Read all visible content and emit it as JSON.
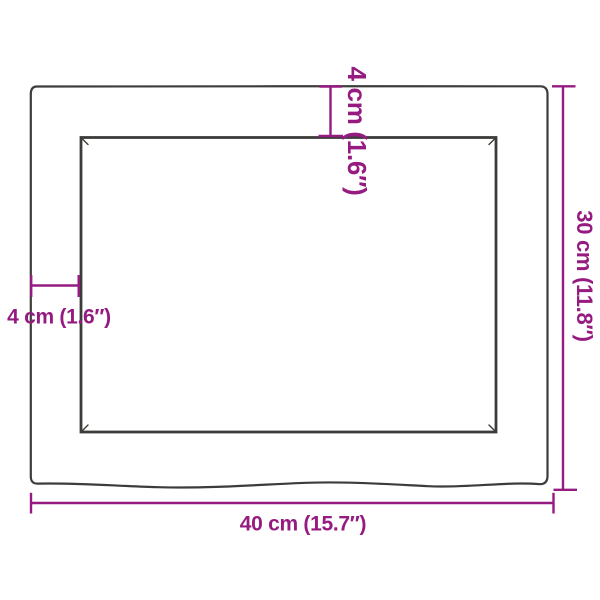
{
  "diagram": {
    "labels": {
      "width": "40 cm (15.7″)",
      "height": "30 cm (11.8″)",
      "thickness_top": "4 cm (1.6″)",
      "thickness_left": "4 cm (1.6″)"
    },
    "colors": {
      "dimension_accent": "#951b81",
      "outline": "#3c3c3b",
      "background": "#ffffff"
    }
  }
}
